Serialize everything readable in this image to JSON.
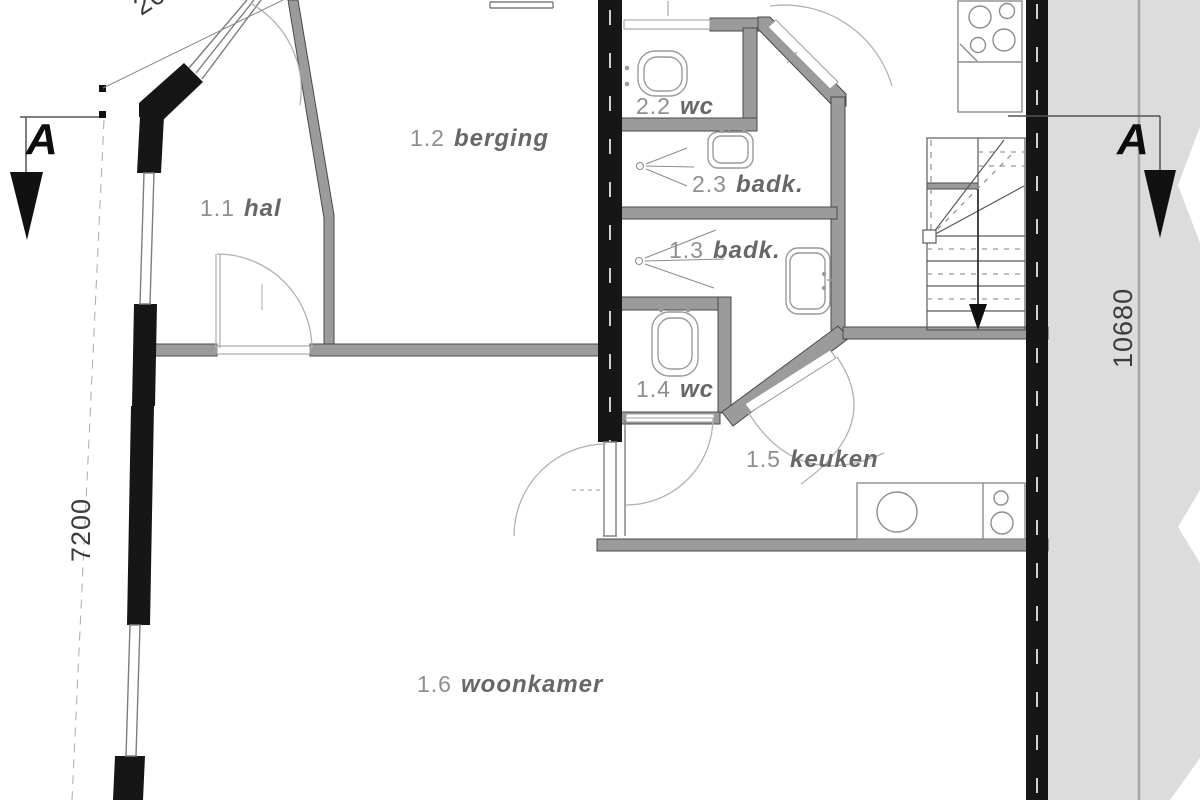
{
  "drawing": {
    "type": "floor-plan",
    "rooms": [
      {
        "number": "1.1",
        "name": "hal"
      },
      {
        "number": "1.2",
        "name": "berging"
      },
      {
        "number": "2.2",
        "name": "wc"
      },
      {
        "number": "2.3",
        "name": "badk."
      },
      {
        "number": "1.3",
        "name": "badk."
      },
      {
        "number": "1.4",
        "name": "wc"
      },
      {
        "number": "1.5",
        "name": "keuken"
      },
      {
        "number": "1.6",
        "name": "woonkamer"
      }
    ],
    "dimensions": {
      "left_wall": "7200",
      "right_wall": "10680",
      "top_partial": "200"
    },
    "section_markers": {
      "left": "A",
      "right": "A"
    },
    "colors": {
      "wall_fill": "#9b9b9b",
      "wall_edge": "#4a4a4a",
      "cut_wall": "#161616",
      "site_band": "#dcdcdc",
      "label_number": "#8f8f8f",
      "label_name": "#676767"
    }
  }
}
